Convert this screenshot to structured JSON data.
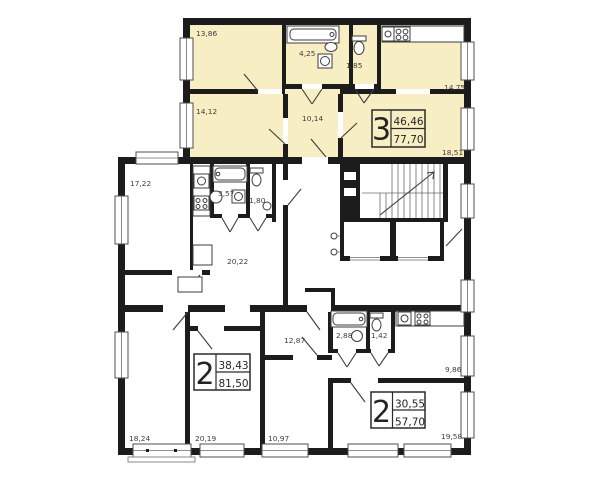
{
  "colors": {
    "highlight": "#f8eec4",
    "wall": "#1c1c1c",
    "line": "#3c3c3c",
    "background": "#ffffff",
    "label_text": "#3e3e3e",
    "stamp_text": "#242424"
  },
  "apartments": [
    {
      "id": "apartment-3",
      "number": "3",
      "living_area": "46,46",
      "total_area": "77,70",
      "highlighted": true,
      "rooms": [
        {
          "type": "bedroom",
          "area": "13,86"
        },
        {
          "type": "bedroom",
          "area": "14,12"
        },
        {
          "type": "living-room",
          "area": "18,51"
        },
        {
          "type": "kitchen",
          "area": "14,75"
        },
        {
          "type": "hallway",
          "area": "10,14"
        },
        {
          "type": "bathroom",
          "area": "4,25"
        },
        {
          "type": "wc",
          "area": "1,85"
        }
      ]
    },
    {
      "id": "apartment-2-left",
      "number": "2",
      "living_area": "38,43",
      "total_area": "81,50",
      "highlighted": false,
      "rooms": [
        {
          "type": "room",
          "area": "17,22"
        },
        {
          "type": "living-room",
          "area": "20,22"
        },
        {
          "type": "bedroom",
          "area": "18,24"
        },
        {
          "type": "bedroom",
          "area": "20,19"
        },
        {
          "type": "bathroom",
          "area": "3,57"
        },
        {
          "type": "wc",
          "area": "1,80"
        }
      ]
    },
    {
      "id": "apartment-2-right",
      "number": "2",
      "living_area": "30,55",
      "total_area": "57,70",
      "highlighted": false,
      "rooms": [
        {
          "type": "hallway",
          "area": "12,87"
        },
        {
          "type": "bedroom",
          "area": "10,97"
        },
        {
          "type": "living-room",
          "area": "19,58"
        },
        {
          "type": "kitchen",
          "area": "9,86"
        },
        {
          "type": "bathroom",
          "area": "2,88"
        },
        {
          "type": "wc",
          "area": "1,42"
        }
      ]
    }
  ]
}
